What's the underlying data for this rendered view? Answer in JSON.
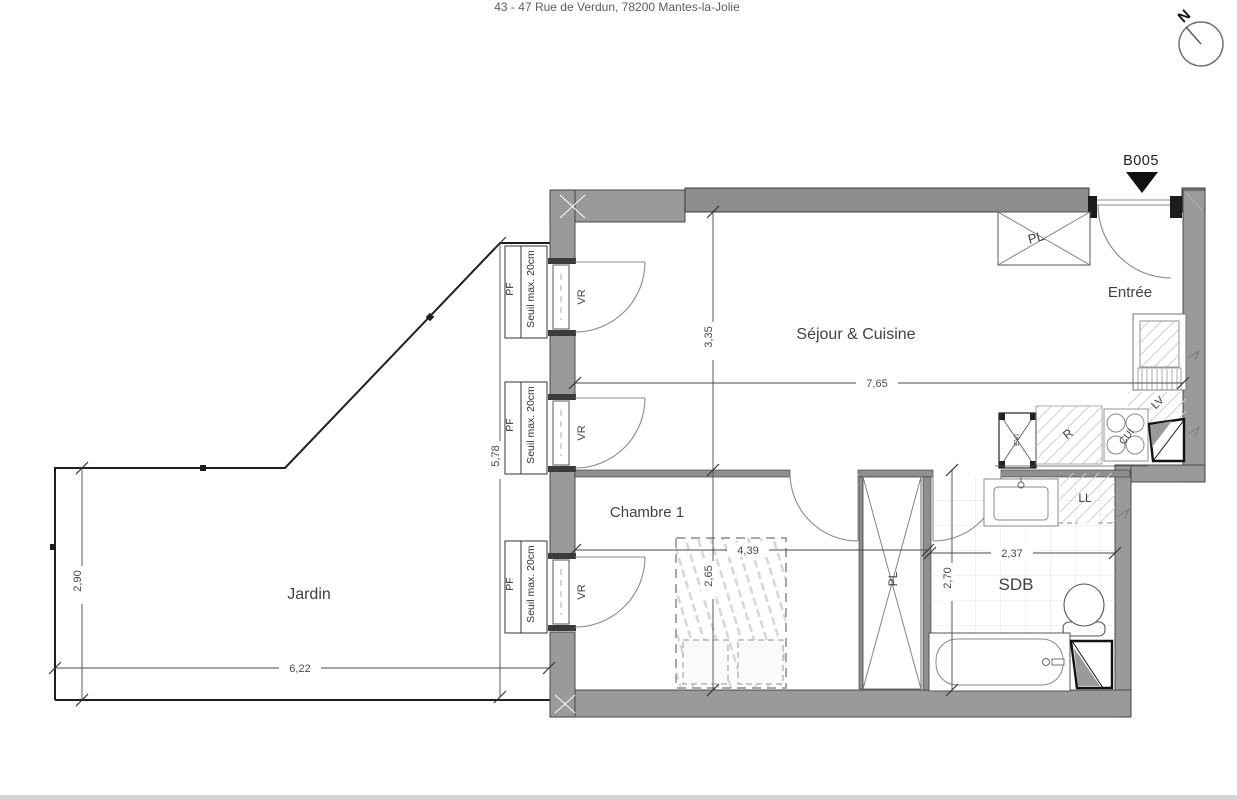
{
  "header": {
    "address": "43 - 47 Rue de Verdun, 78200 Mantes-la-Jolie"
  },
  "compass": {
    "north": "N"
  },
  "unit": {
    "id": "B005"
  },
  "rooms": {
    "sejour_cuisine": "Séjour & Cuisine",
    "entree": "Entrée",
    "chambre1": "Chambre 1",
    "sdb": "SDB",
    "jardin": "Jardin"
  },
  "fixtures": {
    "placard": "PL",
    "volet_roulant": "VR",
    "lave_vaisselle": "LV",
    "lave_linge": "LL",
    "refrigerateur": "R",
    "cuisson": "CUI",
    "evier": "EVI"
  },
  "window_note": {
    "pf": "PF",
    "seuil": "Seuil max. 20cm"
  },
  "dimensions": {
    "sejour_depth": "3,35",
    "sejour_width": "7,65",
    "facade": "5,78",
    "jardin_depth": "2,90",
    "jardin_width": "6,22",
    "chambre_width": "4,39",
    "chambre_depth": "2,65",
    "sdb_width": "2,37",
    "sdb_depth": "2,70"
  },
  "colors": {
    "wall": "#9a9a9a",
    "wall_dark": "#8d8d8d",
    "label": "#3a434a",
    "dimension": "#4a4a4a"
  }
}
